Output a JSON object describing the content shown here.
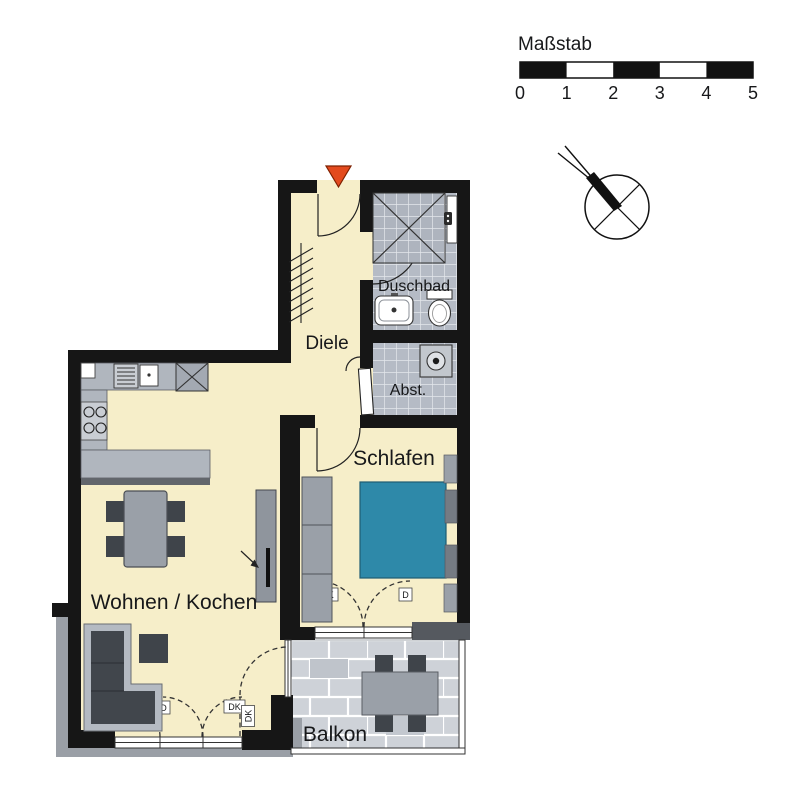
{
  "scale_bar": {
    "label": "Maßstab",
    "ticks": [
      "0",
      "1",
      "2",
      "3",
      "4",
      "5"
    ]
  },
  "rooms": {
    "diele": {
      "label": "Diele"
    },
    "duschbad": {
      "label": "Duschbad"
    },
    "abstellraum": {
      "label": "Abst."
    },
    "schlafen": {
      "label": "Schlafen"
    },
    "wohnen_kochen": {
      "label": "Wohnen / Kochen"
    },
    "balkon": {
      "label": "Balkon"
    }
  },
  "door_codes": {
    "dk": "DK",
    "d": "D"
  },
  "icons": {
    "entry_marker": "red-entry-triangle",
    "north_arrow": "compass-rose-pointing-northwest"
  },
  "colors": {
    "wall": "#161616",
    "floor": "#f6eec9",
    "tile": "#b5bbc5",
    "paver": "#ced2d8",
    "bed": "#2e89a9",
    "furniture": "#9aa0a8",
    "furniture_dark": "#3f444a",
    "entry_marker": "#e34a1e"
  }
}
